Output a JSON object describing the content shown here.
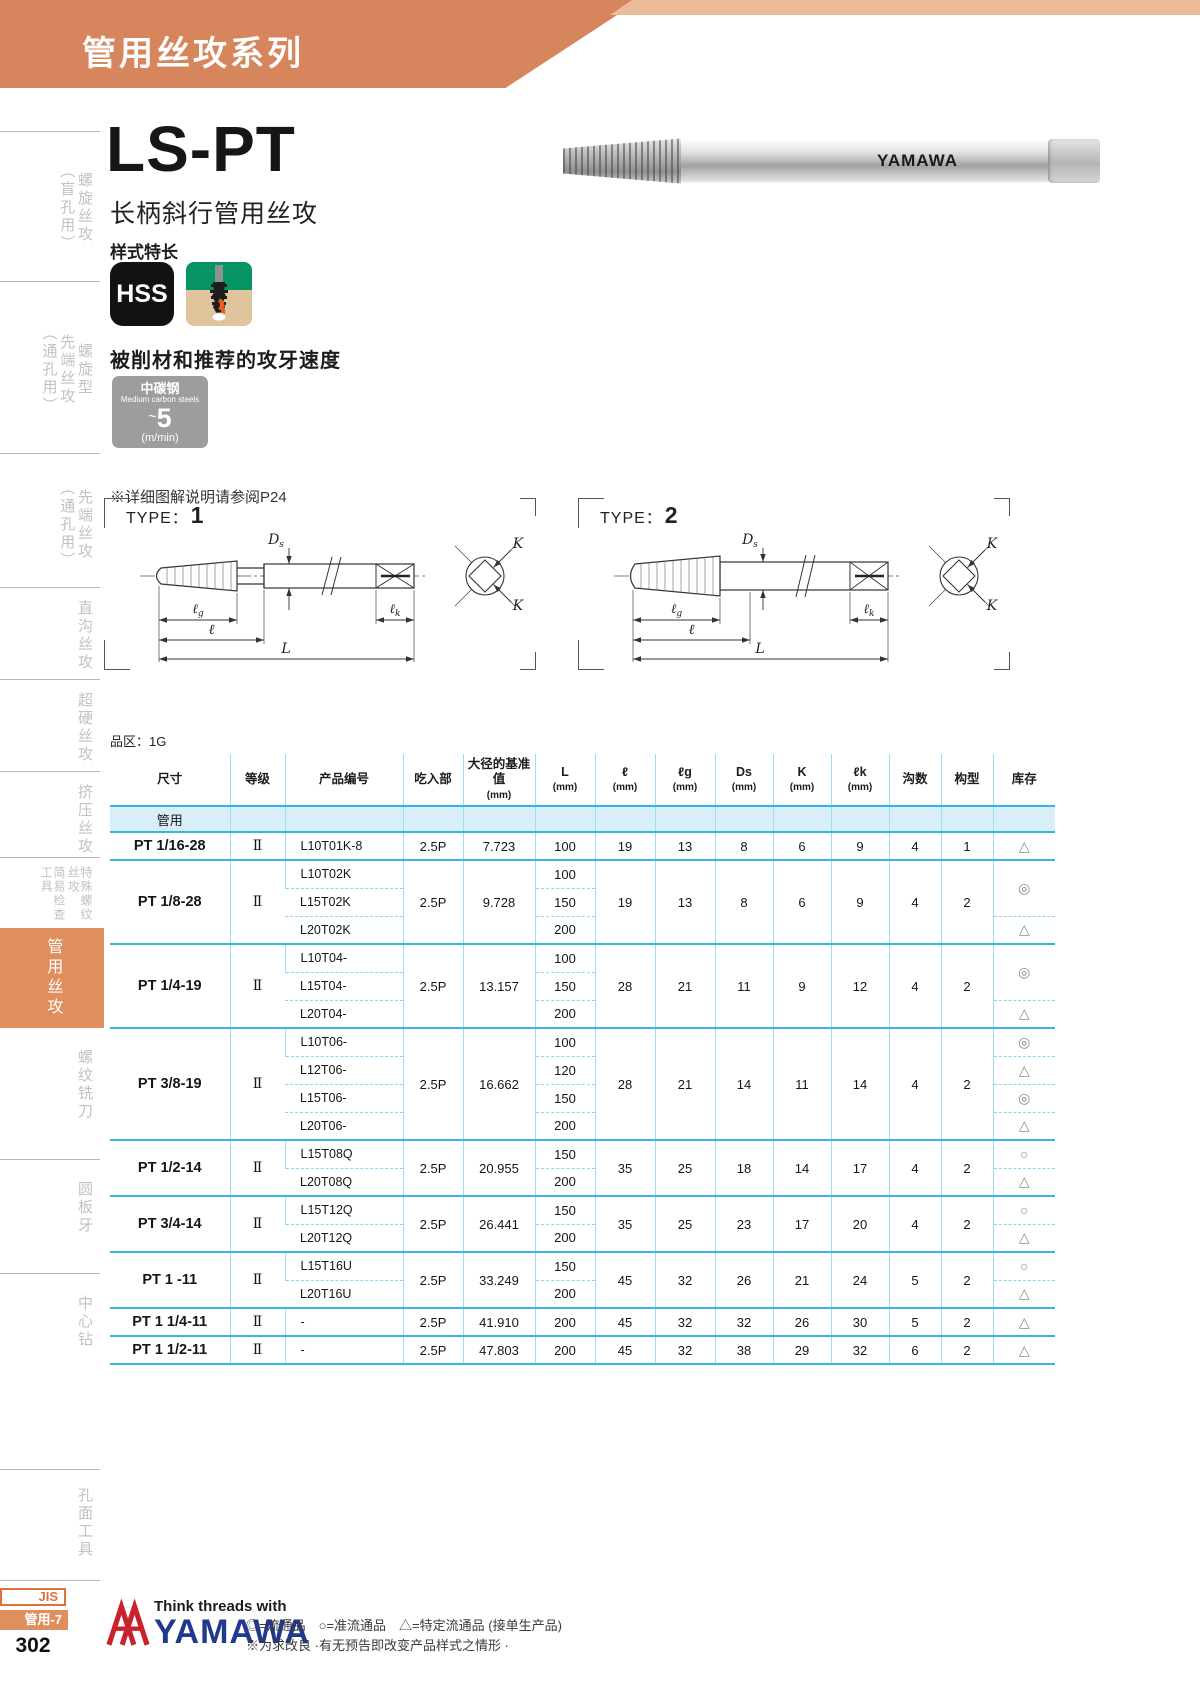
{
  "banner": {
    "title": "管用丝攻系列"
  },
  "sidebar": {
    "items": [
      {
        "cols": [
          "螺旋丝攻",
          "（盲孔用）"
        ],
        "top": 140,
        "height": 135,
        "divider": true,
        "active": false,
        "small": false,
        "name": "luoxuan-sigong-mangkong"
      },
      {
        "cols": [
          "螺旋型",
          "先端丝攻",
          "（通孔用）"
        ],
        "top": 290,
        "height": 160,
        "divider": true,
        "active": false,
        "small": false,
        "name": "luoxuanxing-xianduan-sigong"
      },
      {
        "cols": [
          "先端丝攻",
          "（通孔用）"
        ],
        "top": 462,
        "height": 125,
        "divider": true,
        "active": false,
        "small": false,
        "name": "xianduan-sigong-tongkong"
      },
      {
        "cols": [
          "直沟丝攻"
        ],
        "top": 596,
        "height": 80,
        "divider": true,
        "active": false,
        "small": false,
        "name": "zhigou-sigong"
      },
      {
        "cols": [
          "超硬丝攻"
        ],
        "top": 688,
        "height": 80,
        "divider": true,
        "active": false,
        "small": false,
        "name": "chaoying-sigong"
      },
      {
        "cols": [
          "挤压丝攻"
        ],
        "top": 780,
        "height": 80,
        "divider": true,
        "active": false,
        "small": false,
        "name": "jiya-sigong"
      },
      {
        "cols": [
          "特殊螺纹丝攻",
          "简易检查工具"
        ],
        "top": 866,
        "height": 60,
        "divider": true,
        "active": false,
        "small": true,
        "name": "teshu-luowen-sigong"
      },
      {
        "cols": [
          "管用丝攻"
        ],
        "top": 928,
        "height": 100,
        "divider": false,
        "active": true,
        "small": false,
        "name": "guanyong-sigong"
      },
      {
        "cols": [
          "螺纹铣刀"
        ],
        "top": 1040,
        "height": 90,
        "divider": false,
        "active": false,
        "small": false,
        "name": "luowen-xidao"
      },
      {
        "cols": [
          "圆板牙"
        ],
        "top": 1168,
        "height": 80,
        "divider": true,
        "active": false,
        "small": false,
        "name": "yuanbanya"
      },
      {
        "cols": [
          "中心钻"
        ],
        "top": 1282,
        "height": 80,
        "divider": true,
        "active": false,
        "small": false,
        "name": "zhongxinzuan"
      },
      {
        "cols": [
          "孔面工具"
        ],
        "top": 1478,
        "height": 90,
        "divider": true,
        "active": false,
        "small": false,
        "name": "kongmian-gongju"
      }
    ]
  },
  "product": {
    "model": "LS-PT",
    "subtitle": "长柄斜行管用丝攻",
    "features_label": "样式特长",
    "hss_label": "HSS",
    "brand_on_tool": "YAMAWA"
  },
  "speed": {
    "heading": "被削材和推荐的攻牙速度",
    "material_cn": "中碳钢",
    "material_en": "Medium carbon steels",
    "approx": "~",
    "value": "5",
    "unit": "(m/min)"
  },
  "note_p24": "※详细图解说明请参阅P24",
  "lot_label": "品区：1G",
  "diagrams": {
    "type_prefix": "TYPE：",
    "type1_num": "1",
    "type2_num": "2",
    "labels": {
      "ds_main": "D",
      "ds_sub": "s",
      "lg_main": "ℓ",
      "lg_sub": "g",
      "l": "ℓ",
      "L": "L",
      "lk_main": "ℓ",
      "lk_sub": "k",
      "k": "K"
    }
  },
  "table": {
    "band_label": "管用",
    "headers": [
      {
        "label": "尺寸"
      },
      {
        "label": "等级"
      },
      {
        "label": "产品编号"
      },
      {
        "label": "吃入部"
      },
      {
        "label": "大径的基准值",
        "unit": "(mm)"
      },
      {
        "label": "L",
        "unit": "(mm)"
      },
      {
        "label": "ℓ",
        "unit": "(mm)"
      },
      {
        "label": "ℓg",
        "unit": "(mm)"
      },
      {
        "label": "Ds",
        "unit": "(mm)"
      },
      {
        "label": "K",
        "unit": "(mm)"
      },
      {
        "label": "ℓk",
        "unit": "(mm)"
      },
      {
        "label": "沟数"
      },
      {
        "label": "构型"
      },
      {
        "label": "库存"
      }
    ],
    "col_widths": [
      120,
      55,
      118,
      60,
      72,
      60,
      60,
      60,
      58,
      58,
      58,
      52,
      52,
      62
    ],
    "groups": [
      {
        "size": "PT 1/16-28",
        "grade": "Ⅱ",
        "chamfer": "2.5P",
        "dia": "7.723",
        "l": "19",
        "lg": "13",
        "ds": "8",
        "k": "6",
        "lk": "9",
        "flutes": "4",
        "form": "1",
        "rows": [
          {
            "code": "L10T01K-8",
            "L": "100",
            "stock": "△",
            "stock_span": 1
          }
        ]
      },
      {
        "size": "PT 1/8-28",
        "grade": "Ⅱ",
        "chamfer": "2.5P",
        "dia": "9.728",
        "l": "19",
        "lg": "13",
        "ds": "8",
        "k": "6",
        "lk": "9",
        "flutes": "4",
        "form": "2",
        "rows": [
          {
            "code": "L10T02K",
            "L": "100",
            "stock": "◎",
            "stock_span": 2
          },
          {
            "code": "L15T02K",
            "L": "150",
            "stock": null
          },
          {
            "code": "L20T02K",
            "L": "200",
            "stock": "△",
            "stock_span": 1
          }
        ]
      },
      {
        "size": "PT 1/4-19",
        "grade": "Ⅱ",
        "chamfer": "2.5P",
        "dia": "13.157",
        "l": "28",
        "lg": "21",
        "ds": "11",
        "k": "9",
        "lk": "12",
        "flutes": "4",
        "form": "2",
        "rows": [
          {
            "code": "L10T04-",
            "L": "100",
            "stock": "◎",
            "stock_span": 2
          },
          {
            "code": "L15T04-",
            "L": "150",
            "stock": null
          },
          {
            "code": "L20T04-",
            "L": "200",
            "stock": "△",
            "stock_span": 1
          }
        ]
      },
      {
        "size": "PT 3/8-19",
        "grade": "Ⅱ",
        "chamfer": "2.5P",
        "dia": "16.662",
        "l": "28",
        "lg": "21",
        "ds": "14",
        "k": "11",
        "lk": "14",
        "flutes": "4",
        "form": "2",
        "rows": [
          {
            "code": "L10T06-",
            "L": "100",
            "stock": "◎",
            "stock_span": 1
          },
          {
            "code": "L12T06-",
            "L": "120",
            "stock": "△",
            "stock_span": 1
          },
          {
            "code": "L15T06-",
            "L": "150",
            "stock": "◎",
            "stock_span": 1
          },
          {
            "code": "L20T06-",
            "L": "200",
            "stock": "△",
            "stock_span": 1
          }
        ]
      },
      {
        "size": "PT 1/2-14",
        "grade": "Ⅱ",
        "chamfer": "2.5P",
        "dia": "20.955",
        "l": "35",
        "lg": "25",
        "ds": "18",
        "k": "14",
        "lk": "17",
        "flutes": "4",
        "form": "2",
        "rows": [
          {
            "code": "L15T08Q",
            "L": "150",
            "stock": "○",
            "stock_span": 1
          },
          {
            "code": "L20T08Q",
            "L": "200",
            "stock": "△",
            "stock_span": 1
          }
        ]
      },
      {
        "size": "PT 3/4-14",
        "grade": "Ⅱ",
        "chamfer": "2.5P",
        "dia": "26.441",
        "l": "35",
        "lg": "25",
        "ds": "23",
        "k": "17",
        "lk": "20",
        "flutes": "4",
        "form": "2",
        "rows": [
          {
            "code": "L15T12Q",
            "L": "150",
            "stock": "○",
            "stock_span": 1
          },
          {
            "code": "L20T12Q",
            "L": "200",
            "stock": "△",
            "stock_span": 1
          }
        ]
      },
      {
        "size": "PT 1 -11",
        "grade": "Ⅱ",
        "chamfer": "2.5P",
        "dia": "33.249",
        "l": "45",
        "lg": "32",
        "ds": "26",
        "k": "21",
        "lk": "24",
        "flutes": "5",
        "form": "2",
        "rows": [
          {
            "code": "L15T16U",
            "L": "150",
            "stock": "○",
            "stock_span": 1
          },
          {
            "code": "L20T16U",
            "L": "200",
            "stock": "△",
            "stock_span": 1
          }
        ]
      },
      {
        "size": "PT 1 1/4-11",
        "grade": "Ⅱ",
        "chamfer": "2.5P",
        "dia": "41.910",
        "l": "45",
        "lg": "32",
        "ds": "32",
        "k": "26",
        "lk": "30",
        "flutes": "5",
        "form": "2",
        "rows": [
          {
            "code": "-",
            "L": "200",
            "stock": "△",
            "stock_span": 1
          }
        ]
      },
      {
        "size": "PT 1 1/2-11",
        "grade": "Ⅱ",
        "chamfer": "2.5P",
        "dia": "47.803",
        "l": "45",
        "lg": "32",
        "ds": "38",
        "k": "29",
        "lk": "32",
        "flutes": "6",
        "form": "2",
        "rows": [
          {
            "code": "-",
            "L": "200",
            "stock": "△",
            "stock_span": 1
          }
        ]
      }
    ]
  },
  "footer": {
    "jis": "JIS",
    "tab": "管用-7",
    "page_number": "302",
    "tagline": "Think threads with",
    "brand": "YAMAWA",
    "legend": "◎=流通品　○=准流通品　△=特定流通品 (接单生产品)",
    "disclaimer": "※为求改良 ·有无预告即改变产品样式之情形 ·"
  }
}
